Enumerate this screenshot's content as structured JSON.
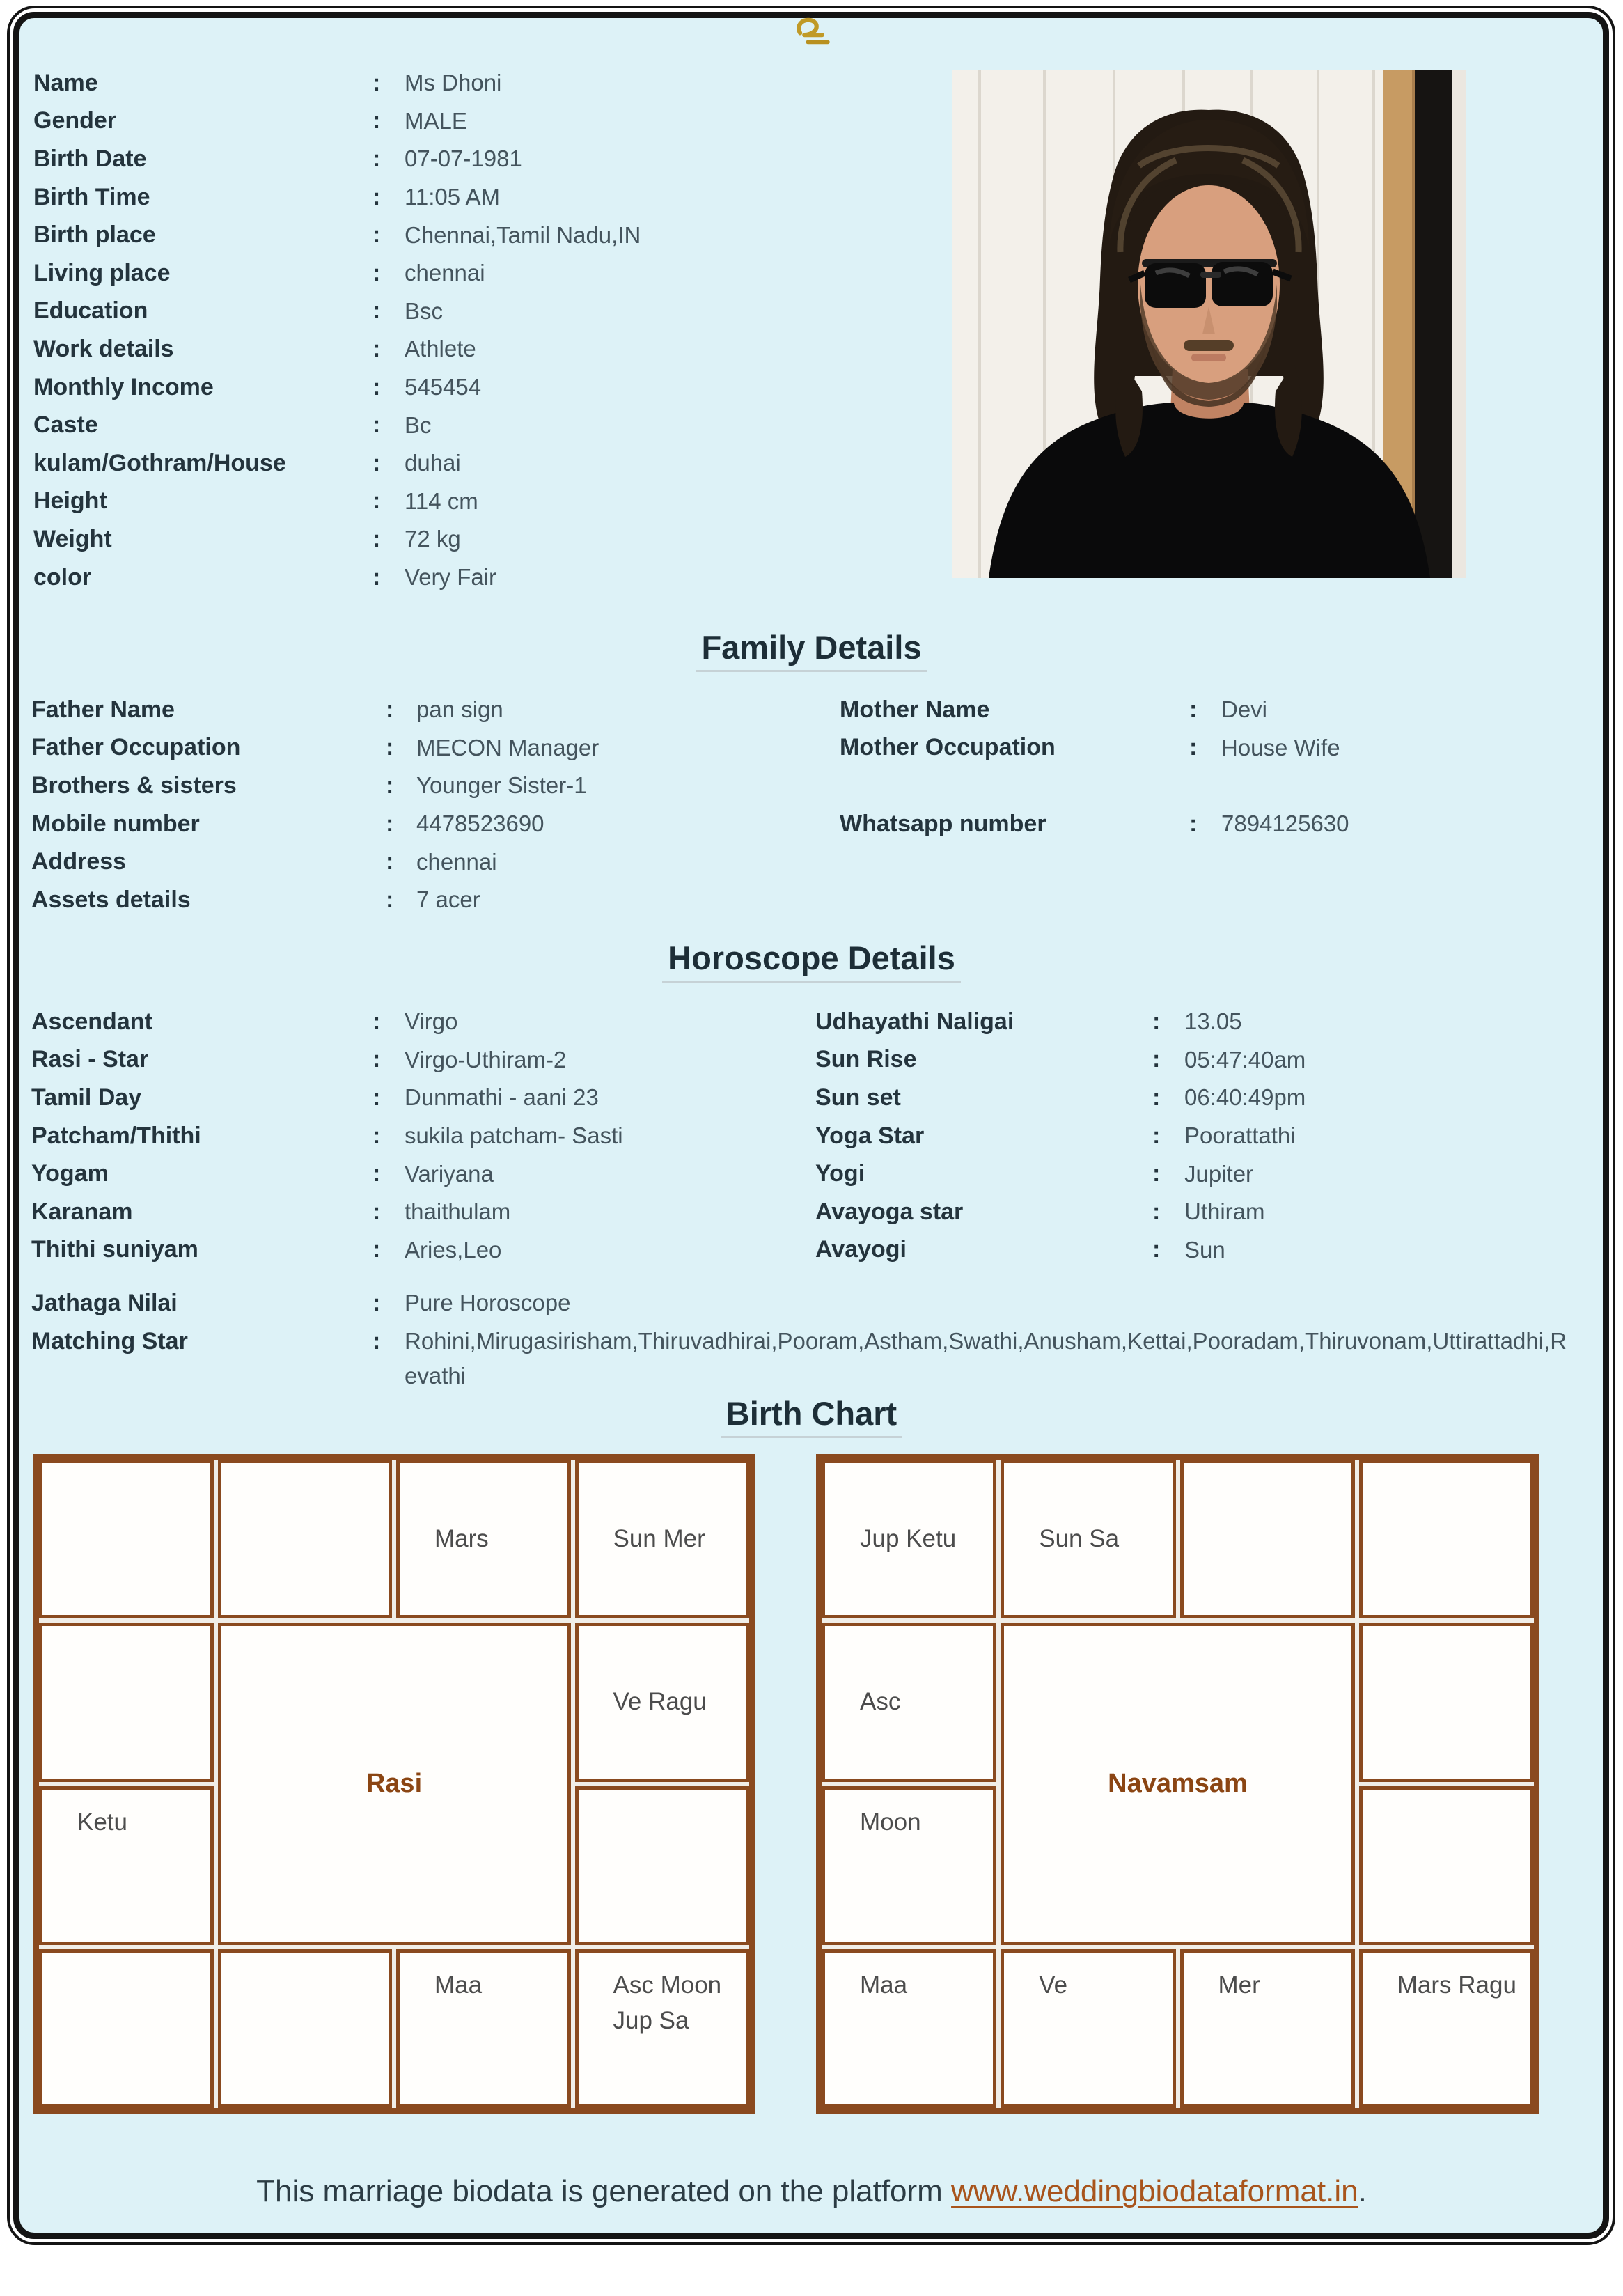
{
  "colon": ":",
  "top_symbol": "உ",
  "personal": {
    "rows": [
      {
        "label": "Name",
        "value": "Ms Dhoni"
      },
      {
        "label": "Gender",
        "value": "MALE"
      },
      {
        "label": "Birth Date",
        "value": "07-07-1981"
      },
      {
        "label": "Birth Time",
        "value": "11:05 AM"
      },
      {
        "label": "Birth place",
        "value": "Chennai,Tamil Nadu,IN"
      },
      {
        "label": "Living place",
        "value": "chennai"
      },
      {
        "label": "Education",
        "value": "Bsc"
      },
      {
        "label": "Work details",
        "value": "Athlete"
      },
      {
        "label": "Monthly Income",
        "value": "545454"
      },
      {
        "label": "Caste",
        "value": "Bc"
      },
      {
        "label": "kulam/Gothram/House",
        "value": "duhai"
      },
      {
        "label": "Height",
        "value": "114 cm"
      },
      {
        "label": "Weight",
        "value": "72 kg"
      },
      {
        "label": "color",
        "value": "Very Fair"
      }
    ]
  },
  "family": {
    "heading": "Family Details",
    "left": [
      {
        "label": "Father Name",
        "value": "pan sign"
      },
      {
        "label": "Father Occupation",
        "value": "MECON Manager"
      },
      {
        "label": "Brothers & sisters",
        "value": "Younger Sister-1"
      },
      {
        "label": "Mobile number",
        "value": "4478523690"
      },
      {
        "label": "Address",
        "value": "chennai"
      },
      {
        "label": "Assets details",
        "value": "7 acer"
      }
    ],
    "right": [
      {
        "label": "Mother Name",
        "value": "Devi"
      },
      {
        "label": "Mother Occupation",
        "value": "House Wife"
      },
      {
        "label": "Whatsapp number",
        "value": "7894125630"
      }
    ]
  },
  "horoscope": {
    "heading": "Horoscope Details",
    "left": [
      {
        "label": "Ascendant",
        "value": "Virgo"
      },
      {
        "label": "Rasi - Star",
        "value": "Virgo-Uthiram-2"
      },
      {
        "label": "Tamil Day",
        "value": "Dunmathi - aani 23"
      },
      {
        "label": "Patcham/Thithi",
        "value": "sukila patcham- Sasti"
      },
      {
        "label": "Yogam",
        "value": "Variyana"
      },
      {
        "label": "Karanam",
        "value": "thaithulam"
      },
      {
        "label": "Thithi suniyam",
        "value": "Aries,Leo"
      }
    ],
    "right": [
      {
        "label": "Udhayathi Naligai",
        "value": "13.05"
      },
      {
        "label": "Sun Rise",
        "value": "05:47:40am"
      },
      {
        "label": "Sun set",
        "value": "06:40:49pm"
      },
      {
        "label": "Yoga Star",
        "value": "Poorattathi"
      },
      {
        "label": "Yogi",
        "value": "Jupiter"
      },
      {
        "label": "Avayoga star",
        "value": "Uthiram"
      },
      {
        "label": "Avayogi",
        "value": "Sun"
      }
    ],
    "extra": [
      {
        "label": "Jathaga Nilai",
        "value": "Pure Horoscope"
      },
      {
        "label": "Matching Star",
        "value": "Rohini,Mirugasirisham,Thiruvadhirai,Pooram,Astham,Swathi,Anusham,Kettai,Pooradam,Thiruvonam,Uttirattadhi,Revathi"
      }
    ]
  },
  "birth_chart": {
    "heading": "Birth Chart",
    "rasi": {
      "title": "Rasi",
      "cells": {
        "r1c1": "",
        "r1c2": "",
        "r1c3": "Mars",
        "r1c4": "Sun Mer",
        "r2c1": "",
        "r2c4": "Ve Ragu",
        "r3c1": "Ketu",
        "r3c4": "",
        "r4c1": "",
        "r4c2": "",
        "r4c3": "Maa",
        "r4c4": "Asc Moon Jup Sa"
      }
    },
    "navamsam": {
      "title": "Navamsam",
      "cells": {
        "r1c1": "Jup Ketu",
        "r1c2": "Sun Sa",
        "r1c3": "",
        "r1c4": "",
        "r2c1": "Asc",
        "r2c4": "",
        "r3c1": "Moon",
        "r3c4": "",
        "r4c1": "Maa",
        "r4c2": "Ve",
        "r4c3": "Mer",
        "r4c4": "Mars Ragu"
      }
    }
  },
  "footer": {
    "prefix": "This marriage biodata is generated on the platform ",
    "link_text": "www.weddingbiodataformat.in",
    "suffix": "."
  },
  "colors": {
    "background": "#ddf2f7",
    "chart_border": "#8a4a1f",
    "chart_title": "#8b4513",
    "link": "#a8541c",
    "symbol_gold": "#c09a27"
  }
}
